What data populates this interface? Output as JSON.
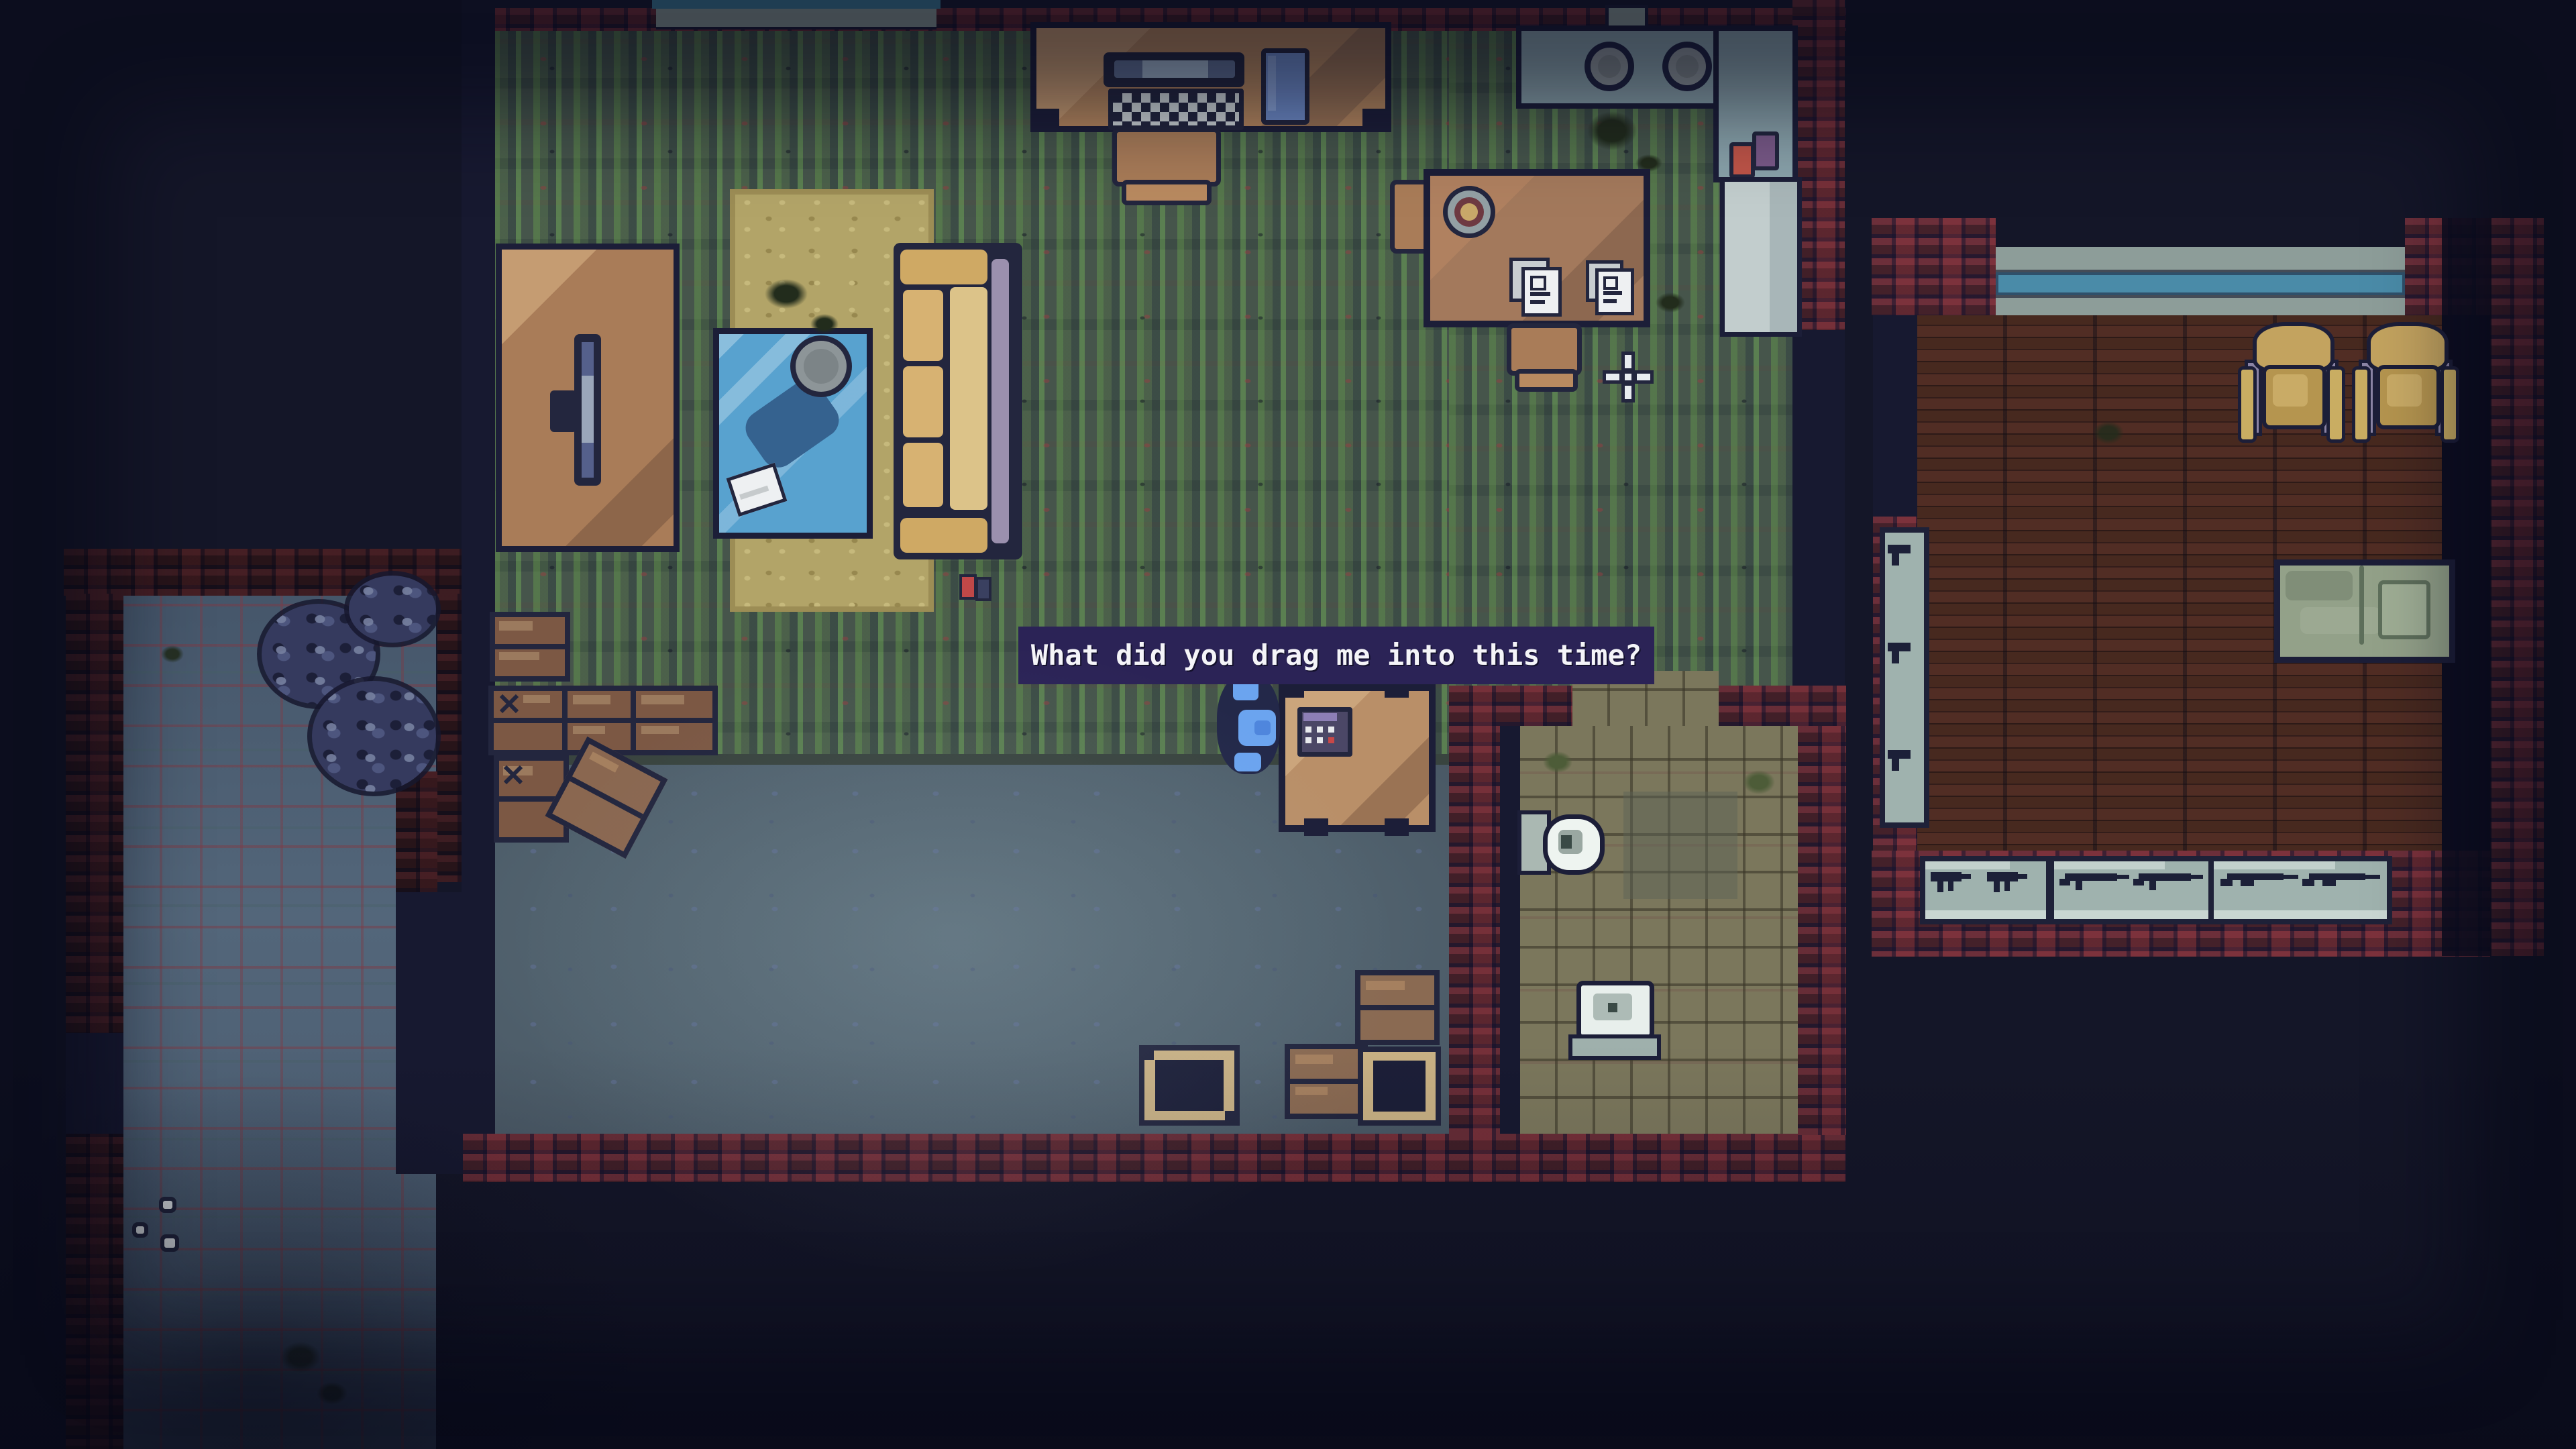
{
  "meta": {
    "view": "top-down pixel-art game scene",
    "resolution": "3840x2160"
  },
  "dialogue": {
    "text": "What did you drag me into this time?",
    "bg_color": "#2b2356",
    "text_color": "#f4f4f8"
  },
  "palette": {
    "background": "#141628",
    "brick_wall": "#4f2631",
    "carpet_green": "#4d5a50",
    "concrete_gray": "#55676f",
    "bathroom_tile": "#7b775c",
    "alley_tile": "#50647a",
    "wood_plank": "#3d231e",
    "furniture_wood": "#b5875e",
    "couch_tan": "#d7b272",
    "rug_tan": "#b2a468",
    "coffee_table_blue": "#58a2cf",
    "counter_gray": "#8aa3ab",
    "case_gray": "#9fb2ae",
    "player_blue": "#6ba4ef",
    "window_cyan": "#3f7f9b"
  },
  "scene": {
    "player": {
      "description": "character in blue hat standing left of small table",
      "zone": "lounge"
    },
    "cursor": {
      "type": "crosshair",
      "zone": "carpet near dining table"
    },
    "rooms": [
      {
        "name": "living-room",
        "floor": "green striped carpet",
        "items": [
          "computer desk",
          "desk chair",
          "tv stand",
          "flatscreen tv",
          "tan rug",
          "blue coffee table",
          "bowl",
          "couch",
          "window"
        ]
      },
      {
        "name": "kitchen",
        "items": [
          "stove counter with two burners",
          "counter column",
          "red bottle",
          "purple bottle",
          "fridge"
        ]
      },
      {
        "name": "dining-nook",
        "items": [
          "dining table",
          "mug",
          "paper stack",
          "paper stack",
          "chair",
          "chair"
        ]
      },
      {
        "name": "lounge-storage",
        "floor": "gray concrete",
        "items": [
          "wooden crates",
          "crate with x mark",
          "tilted crate",
          "open crate",
          "open crate",
          "closed crates",
          "small table",
          "calculator"
        ]
      },
      {
        "name": "bathroom",
        "floor": "khaki tile",
        "items": [
          "toilet",
          "sink",
          "pedestal"
        ]
      },
      {
        "name": "bedroom-armory",
        "floor": "dark wood planks",
        "items": [
          "window",
          "armchair",
          "armchair",
          "green bed",
          "wall gun case",
          "smg display case",
          "rifle display case",
          "shotgun display case"
        ]
      },
      {
        "name": "alley",
        "floor": "blue-gray tile",
        "items": [
          "bush",
          "bush",
          "bush",
          "pebbles",
          "debris"
        ]
      }
    ]
  }
}
